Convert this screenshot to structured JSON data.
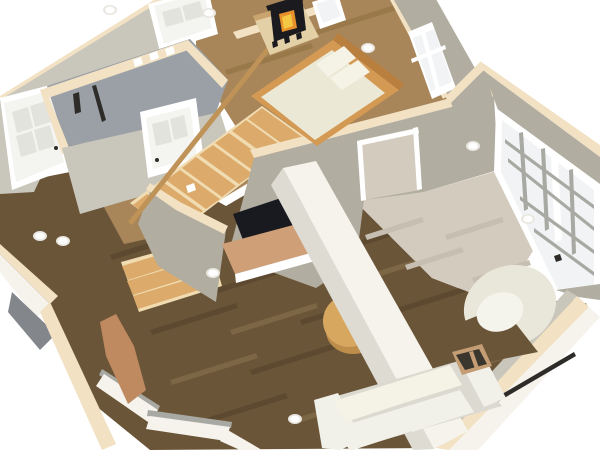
{
  "scene": {
    "view": "3d-aerial-cutaway-home-interior",
    "colors": {
      "bg": "#ffffff",
      "wall_face": "#b1ada0",
      "wall_face_light": "#c9c6bc",
      "wall_face_dark": "#8b887e",
      "wall_top": "#f2e1c3",
      "hearth_edge": "#caa46f",
      "grey_wall": "#9aa0a6",
      "grey_wall_dark": "#83878c",
      "wall_white": "#f6f3ec",
      "wall_white_side": "#dedbd2",
      "floor_dark": "#6b5538",
      "plank_dark": "#5d4930",
      "plank_light": "#7d6645",
      "floor_mid": "#a8865a",
      "plank_mid": "#997849",
      "floor_light": "#d3cbbd",
      "plank_light2": "#c6beb0",
      "stair_tread": "#dcab6b",
      "stair_riser": "#f1dcb2",
      "railing": "#bf9257",
      "trim": "#ffffff",
      "door_white": "#f4f4f1",
      "door_panel": "#e3e3de",
      "door_leaf": "#c08a60",
      "window_pane": "#f1f3f4",
      "window_mullion": "#a9a9a3",
      "bed_frame": "#d49a54",
      "bed_frame_dark": "#b97f3e",
      "bedding": "#ebe8d6",
      "pillow": "#f5f3e6",
      "stove": "#1b1b1f",
      "fire": "#e8902b",
      "fire_glow": "#f5c843",
      "hearth_platform": "#e4d0a6",
      "fireplace": "#191920",
      "hearth_brick": "#cfa077",
      "sofa": "#f1f0e9",
      "sofa_shade": "#dbd9d0",
      "table": "#d8a75f",
      "table_shade": "#bd8d4c",
      "chair": "#e9e7d9",
      "chair_inner": "#f5f4ec",
      "vent_frame": "#c49d74",
      "vent_dark": "#3a352d",
      "heater_dark": "#2e2c28",
      "light_ring": "#e9e7e0",
      "light_fixture": "#ffffff"
    },
    "areas": [
      {
        "id": "bedroom",
        "label": "Bedroom with bed and wood stove"
      },
      {
        "id": "stairwell",
        "label": "Grey basement stairwell"
      },
      {
        "id": "staircase-hall",
        "label": "Staircase and landing"
      },
      {
        "id": "living-room",
        "label": "Living room with fireplace"
      },
      {
        "id": "entry",
        "label": "Entry with open front door"
      },
      {
        "id": "window-hall",
        "label": "Hall along gridded windows"
      }
    ],
    "objects": [
      {
        "id": "double-bed",
        "label": "Double bed with wood frame and pillows"
      },
      {
        "id": "wood-stove",
        "label": "Black wood stove with fire"
      },
      {
        "id": "corner-hearth",
        "label": "Corner hearth platform"
      },
      {
        "id": "staircase",
        "label": "Wooden staircase with landing"
      },
      {
        "id": "stair-railing",
        "label": "Wooden handrail"
      },
      {
        "id": "fireplace",
        "label": "Fireplace opening in wall"
      },
      {
        "id": "hearth-bench",
        "label": "Brick hearth bench"
      },
      {
        "id": "divider-wall",
        "label": "White cut divider wall"
      },
      {
        "id": "loveseat-sofa",
        "label": "White loveseat sofa"
      },
      {
        "id": "round-coffee-table",
        "label": "Round wooden coffee table"
      },
      {
        "id": "swivel-armchair",
        "label": "White curved armchair"
      },
      {
        "id": "floor-register",
        "label": "Floor heating register"
      },
      {
        "id": "front-door-open",
        "label": "Open front door with swing"
      },
      {
        "id": "panel-doors",
        "label": "White six-panel doors"
      },
      {
        "id": "window-bank",
        "label": "Large gridded windows"
      },
      {
        "id": "baseboard-heater",
        "label": "Baseboard heater"
      },
      {
        "id": "ceiling-lights",
        "label": "Floating recessed ceiling lights"
      },
      {
        "id": "wall-outlets",
        "label": "Wall outlets and switches"
      }
    ]
  }
}
